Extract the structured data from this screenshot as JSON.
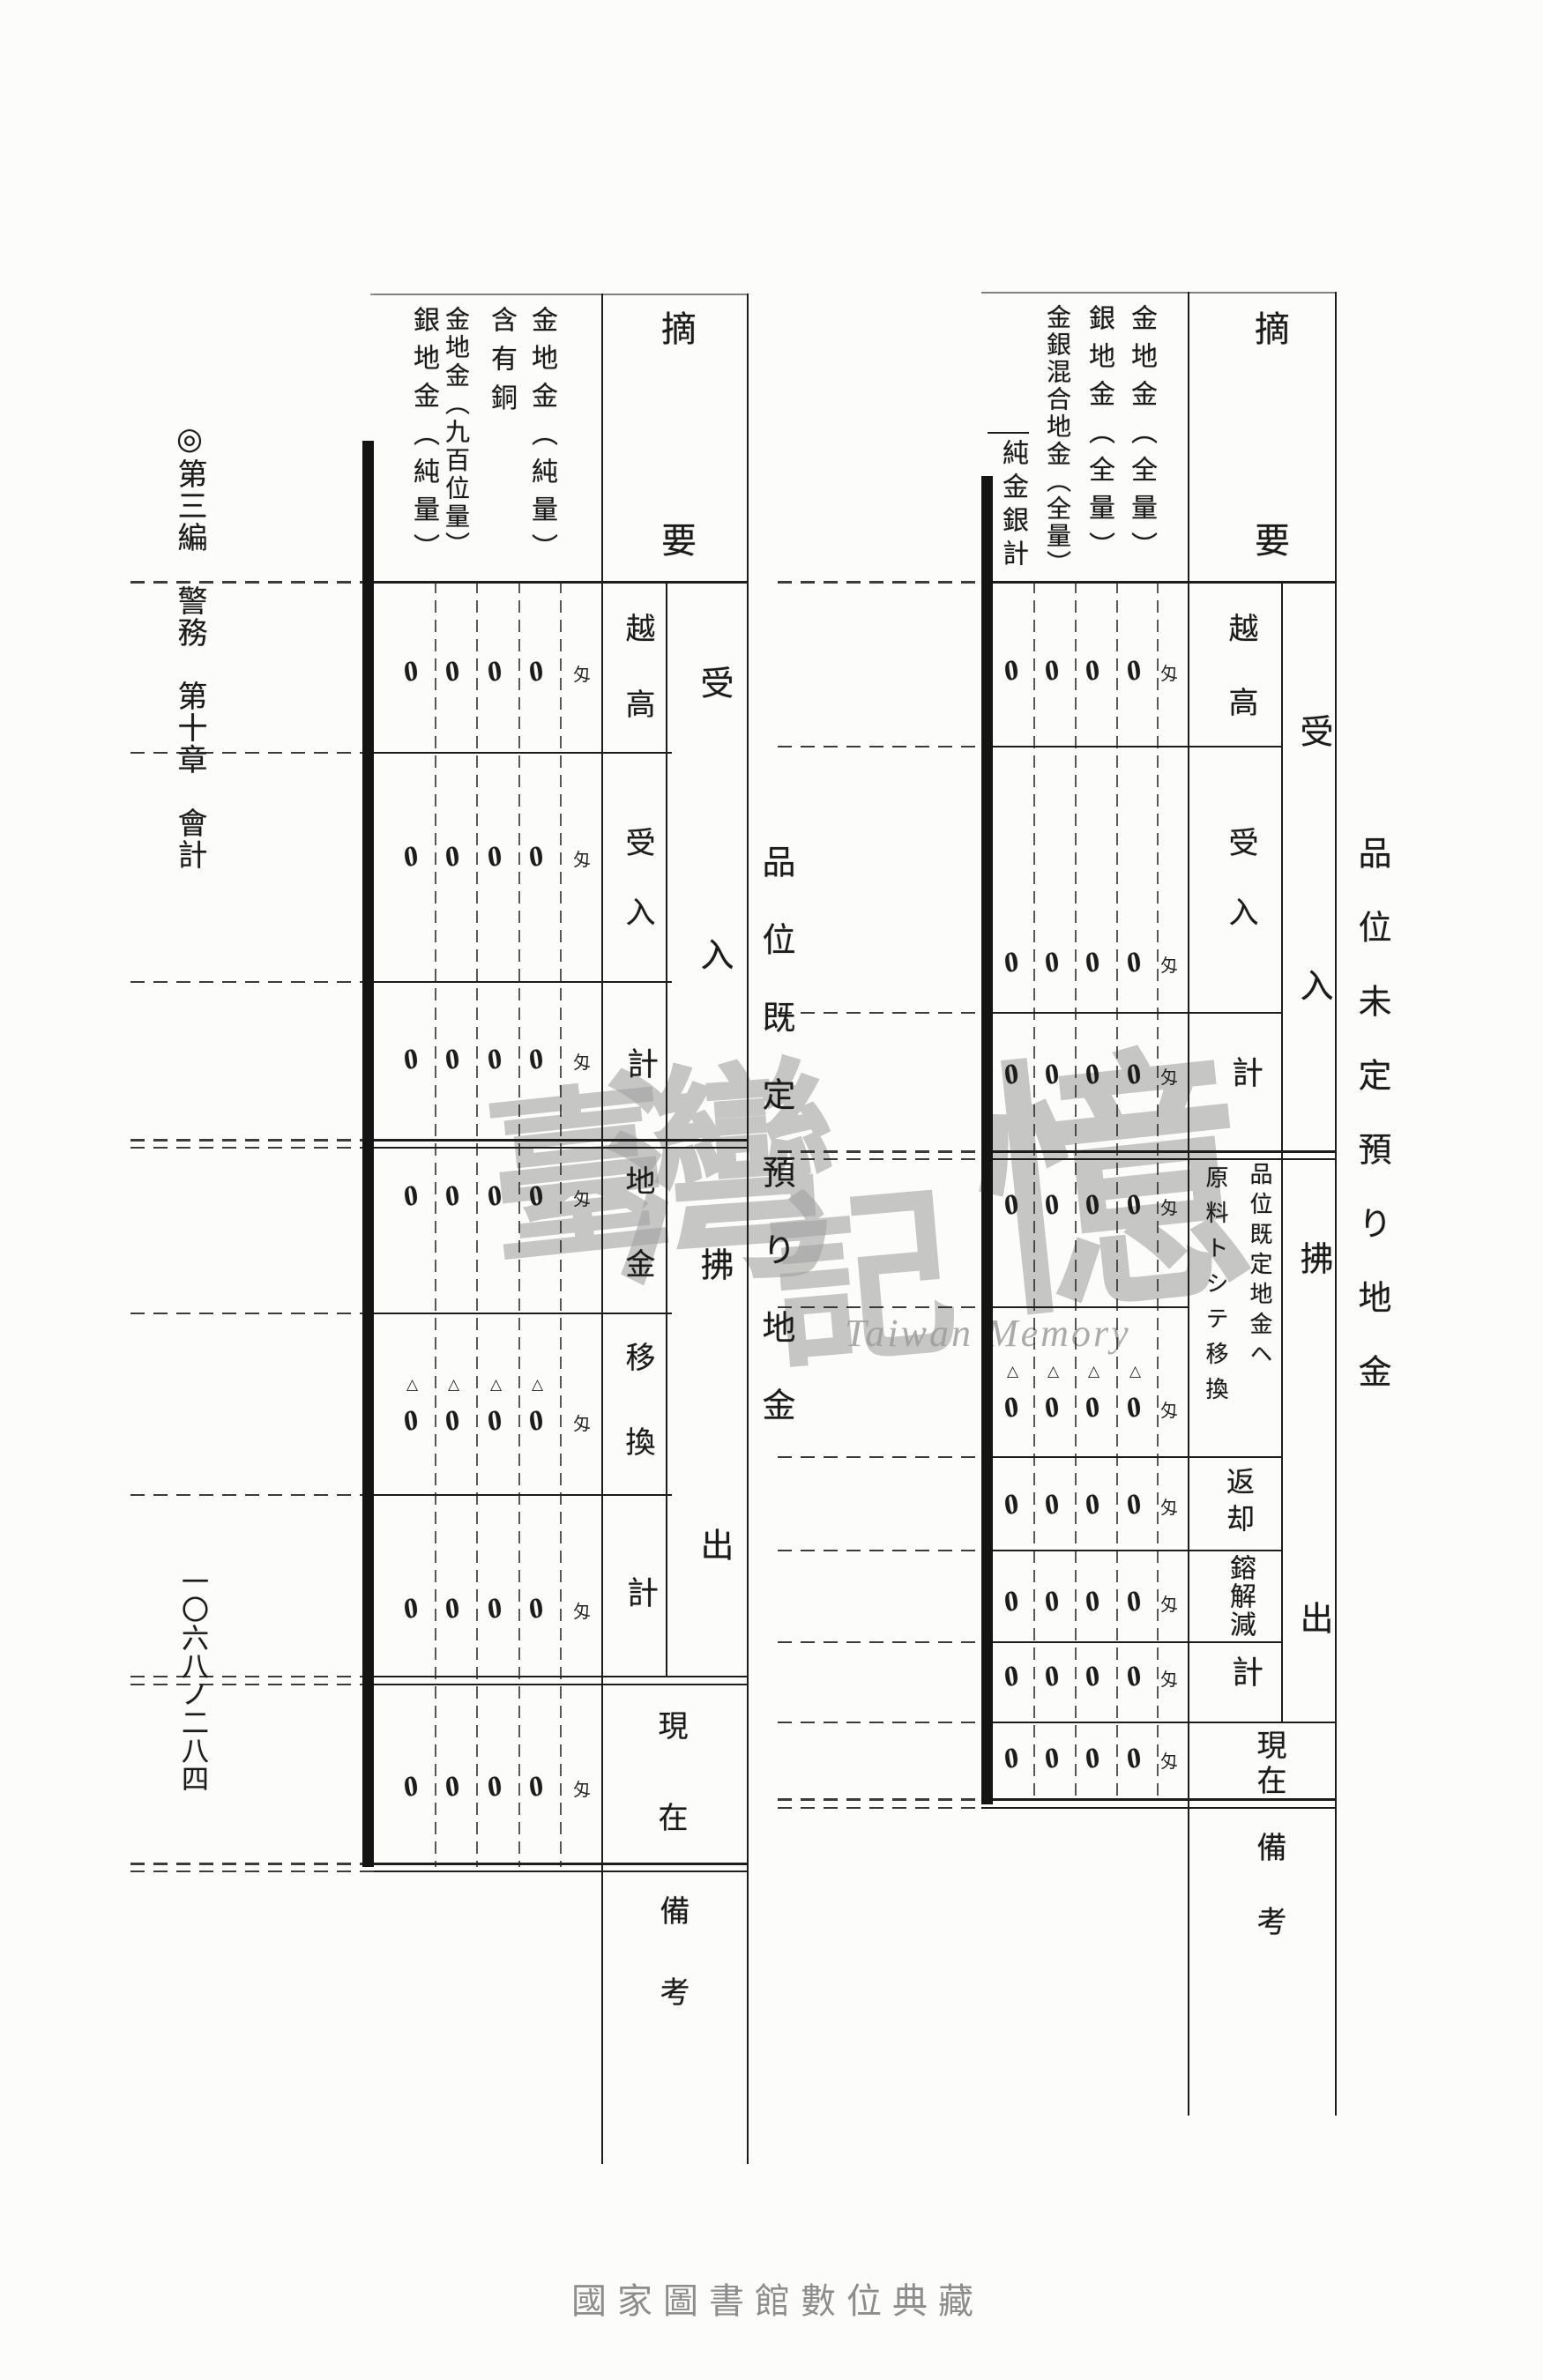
{
  "page": {
    "edition_header": "◎第三編　警務　第十章　會計",
    "page_number": "一〇六八ノ二八四",
    "footer_text": "國家圖書館數位典藏",
    "watermark": {
      "char_1": "臺",
      "char_2": "灣",
      "char_3": "記",
      "char_4": "憶",
      "latin": "Taiwan Memory"
    }
  },
  "table_right": {
    "title": "品位未定預り地金",
    "corner_label": "摘要",
    "unit": "匁",
    "negative_mark": "△",
    "column_labels": [
      "金地金︵全量︶",
      "銀地金︵全量︶",
      "金銀混合地金︵全量︶",
      "純金銀計"
    ],
    "groups": {
      "in": "受入",
      "out": "拂出"
    },
    "row_labels": {
      "carryover": "越高",
      "received": "受入",
      "subtotal_in": "計",
      "transfer_line_1": "品位既定地金ヘ",
      "transfer_line_2": "原料トシテ移換",
      "returned": "返却",
      "melting_loss": "鎔解減",
      "subtotal_out": "計",
      "on_hand": "現在",
      "remarks": "備考"
    },
    "data_rows": [
      {
        "row": "越高",
        "values": [
          "0",
          "0",
          "0",
          "0"
        ],
        "negative": false
      },
      {
        "row": "受入",
        "values": [
          "0",
          "0",
          "0",
          "0"
        ],
        "negative": false
      },
      {
        "row": "計",
        "values": [
          "0",
          "0",
          "0",
          "0"
        ],
        "negative": false
      },
      {
        "row": "品位既定地金ヘ移換(上段)",
        "values": [
          "0",
          "0",
          "0",
          "0"
        ],
        "negative": false
      },
      {
        "row": "品位既定地金ヘ移換(下段)",
        "values": [
          "0",
          "0",
          "0",
          "0"
        ],
        "negative": true
      },
      {
        "row": "返却",
        "values": [
          "0",
          "0",
          "0",
          "0"
        ],
        "negative": false
      },
      {
        "row": "鎔解減",
        "values": [
          "0",
          "0",
          "0",
          "0"
        ],
        "negative": false
      },
      {
        "row": "計(拂出)",
        "values": [
          "0",
          "0",
          "0",
          "0"
        ],
        "negative": false
      },
      {
        "row": "現在",
        "values": [
          "0",
          "0",
          "0",
          "0"
        ],
        "negative": false
      }
    ]
  },
  "table_left": {
    "title": "品位既定預り地金",
    "corner_label": "摘要",
    "unit": "匁",
    "negative_mark": "△",
    "column_labels": [
      "金地金︵純量︶",
      "含有銅",
      "金地金︵九百位量︶",
      "銀地金︵純量︶"
    ],
    "groups": {
      "in": "受入",
      "out": "拂出"
    },
    "row_labels": {
      "carryover": "越高",
      "received": "受入",
      "subtotal_in": "計",
      "bullion": "地金",
      "transfer": "移換",
      "subtotal_out": "計",
      "on_hand": "現在",
      "remarks": "備考"
    },
    "data_rows": [
      {
        "row": "越高",
        "values": [
          "0",
          "0",
          "0",
          "0"
        ],
        "negative": false
      },
      {
        "row": "受入",
        "values": [
          "0",
          "0",
          "0",
          "0"
        ],
        "negative": false
      },
      {
        "row": "計",
        "values": [
          "0",
          "0",
          "0",
          "0"
        ],
        "negative": false
      },
      {
        "row": "地金",
        "values": [
          "0",
          "0",
          "0",
          "0"
        ],
        "negative": false
      },
      {
        "row": "移換",
        "values": [
          "0",
          "0",
          "0",
          "0"
        ],
        "negative": true
      },
      {
        "row": "計(拂出)",
        "values": [
          "0",
          "0",
          "0",
          "0"
        ],
        "negative": false
      },
      {
        "row": "現在",
        "values": [
          "0",
          "0",
          "0",
          "0"
        ],
        "negative": false
      }
    ]
  }
}
